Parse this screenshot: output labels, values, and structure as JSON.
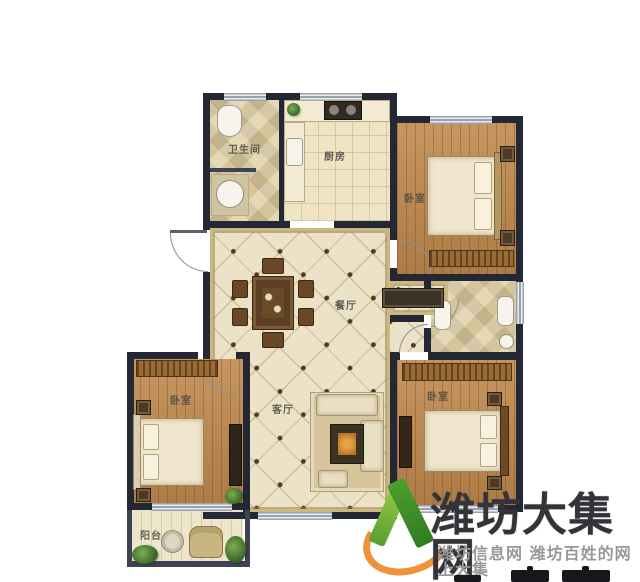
{
  "plan": {
    "rooms": {
      "bathroom": {
        "label": "卫生间"
      },
      "kitchen": {
        "label": "厨房"
      },
      "bedroom_top_right": {
        "label": "卧室"
      },
      "dining": {
        "label": "餐厅"
      },
      "living": {
        "label": "客厅"
      },
      "bedroom_left": {
        "label": "卧室"
      },
      "bedroom_bottom_right": {
        "label": "卧室"
      },
      "balcony": {
        "label": "阳台"
      }
    },
    "colors": {
      "wall": "#242834",
      "wood_floor": "#c18a4e",
      "tile_floor": "#ece2c7",
      "bath_tile": "#e8dcb9",
      "gold_trim": "#cbb87e",
      "window": "#98a2aa",
      "background": "#ffffff"
    }
  },
  "watermark": {
    "title": "潍坊大集网",
    "subtitle": "潍坊信息网 潍坊百姓的网上大集",
    "colors": {
      "title": "#343438",
      "subtitle": "#97989a",
      "logo_green_light": "#8cc63f",
      "logo_green_dark": "#3f8a2a",
      "logo_orange": "#f0923a"
    }
  }
}
